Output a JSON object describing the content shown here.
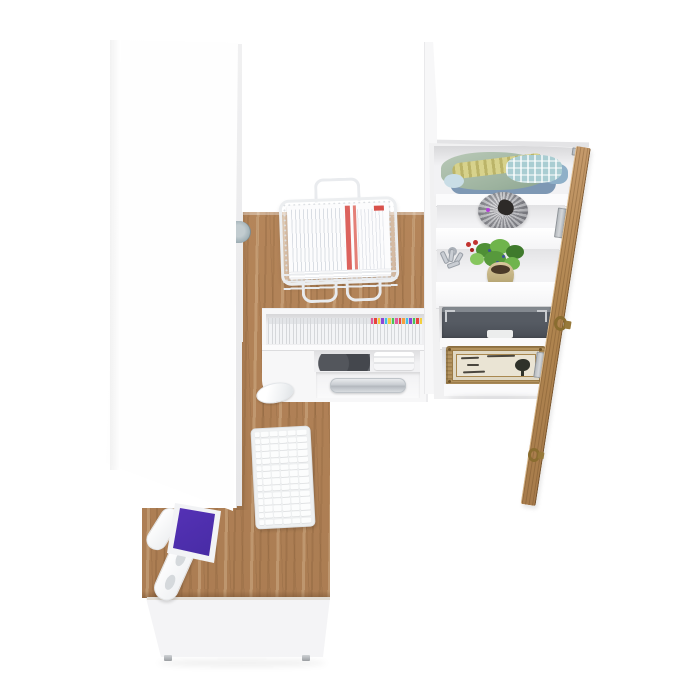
{
  "meta": {
    "description": "Overhead 3D product render of a white and oak home office furniture set"
  },
  "palette": {
    "background": "#ffffff",
    "furniture_white": "#fafafa",
    "wood": "#b1835a",
    "wood_dark": "#8f6a44",
    "drawer_gray": "#50555c",
    "bag_gray": "#9a9da3",
    "wicker_tan": "#b3935f",
    "brass": "#8a6d30",
    "screen_purple": "#6a3ad0",
    "paper_red": "#d8514b",
    "plant_green": "#5a9440"
  },
  "labels": {
    "scene": "home office furniture set, top view render",
    "wardrobe": "tall white wardrobe cabinet",
    "desk": "L-shaped oak desk with white front panel",
    "hutch": "desk hutch with media shelf and storage drawer",
    "cd_shelf": "row of slim media cases with colored caps",
    "document_tray": "white wire mesh tray stacked with printed papers",
    "keyboard": "white wireless keyboard",
    "mouse": "white wireless mouse",
    "monitor": "flat monitor on white articulated arm showing purple galaxy wallpaper",
    "bookcase": "white open shelving tower",
    "shelf_clothes": "folded clothes in green, plaid and denim",
    "shelf_bag": "round grey fabric basket",
    "shelf_plant": "potted green plant, silver keys and red flowers",
    "shelf_drawer": "dark grey storage drawer with white handle",
    "shelf_chest": "wicker chest with ornate cream label",
    "door": "open oak cabinet door with brass ring pulls"
  },
  "media": {
    "cd_cap_colors": [
      "",
      "",
      "",
      "",
      "",
      "",
      "",
      "",
      "",
      "",
      "",
      "",
      "",
      "",
      "",
      "",
      "",
      "",
      "",
      "",
      "",
      "",
      "",
      "",
      "",
      "",
      "",
      "",
      "",
      "#e25a9e",
      "#e8433c",
      "#f2cf3d",
      "#8d46d8",
      "#3fc3e8",
      "#f2cf3d",
      "#48c556",
      "#e25a9e",
      "#e8433c",
      "#f2a13e",
      "#3fc3e8",
      "#8d46d8",
      "#48c556",
      "#e8433c",
      "#f2cf3d"
    ]
  },
  "keyboard_grid": {
    "rows": 14,
    "cols": 6
  }
}
